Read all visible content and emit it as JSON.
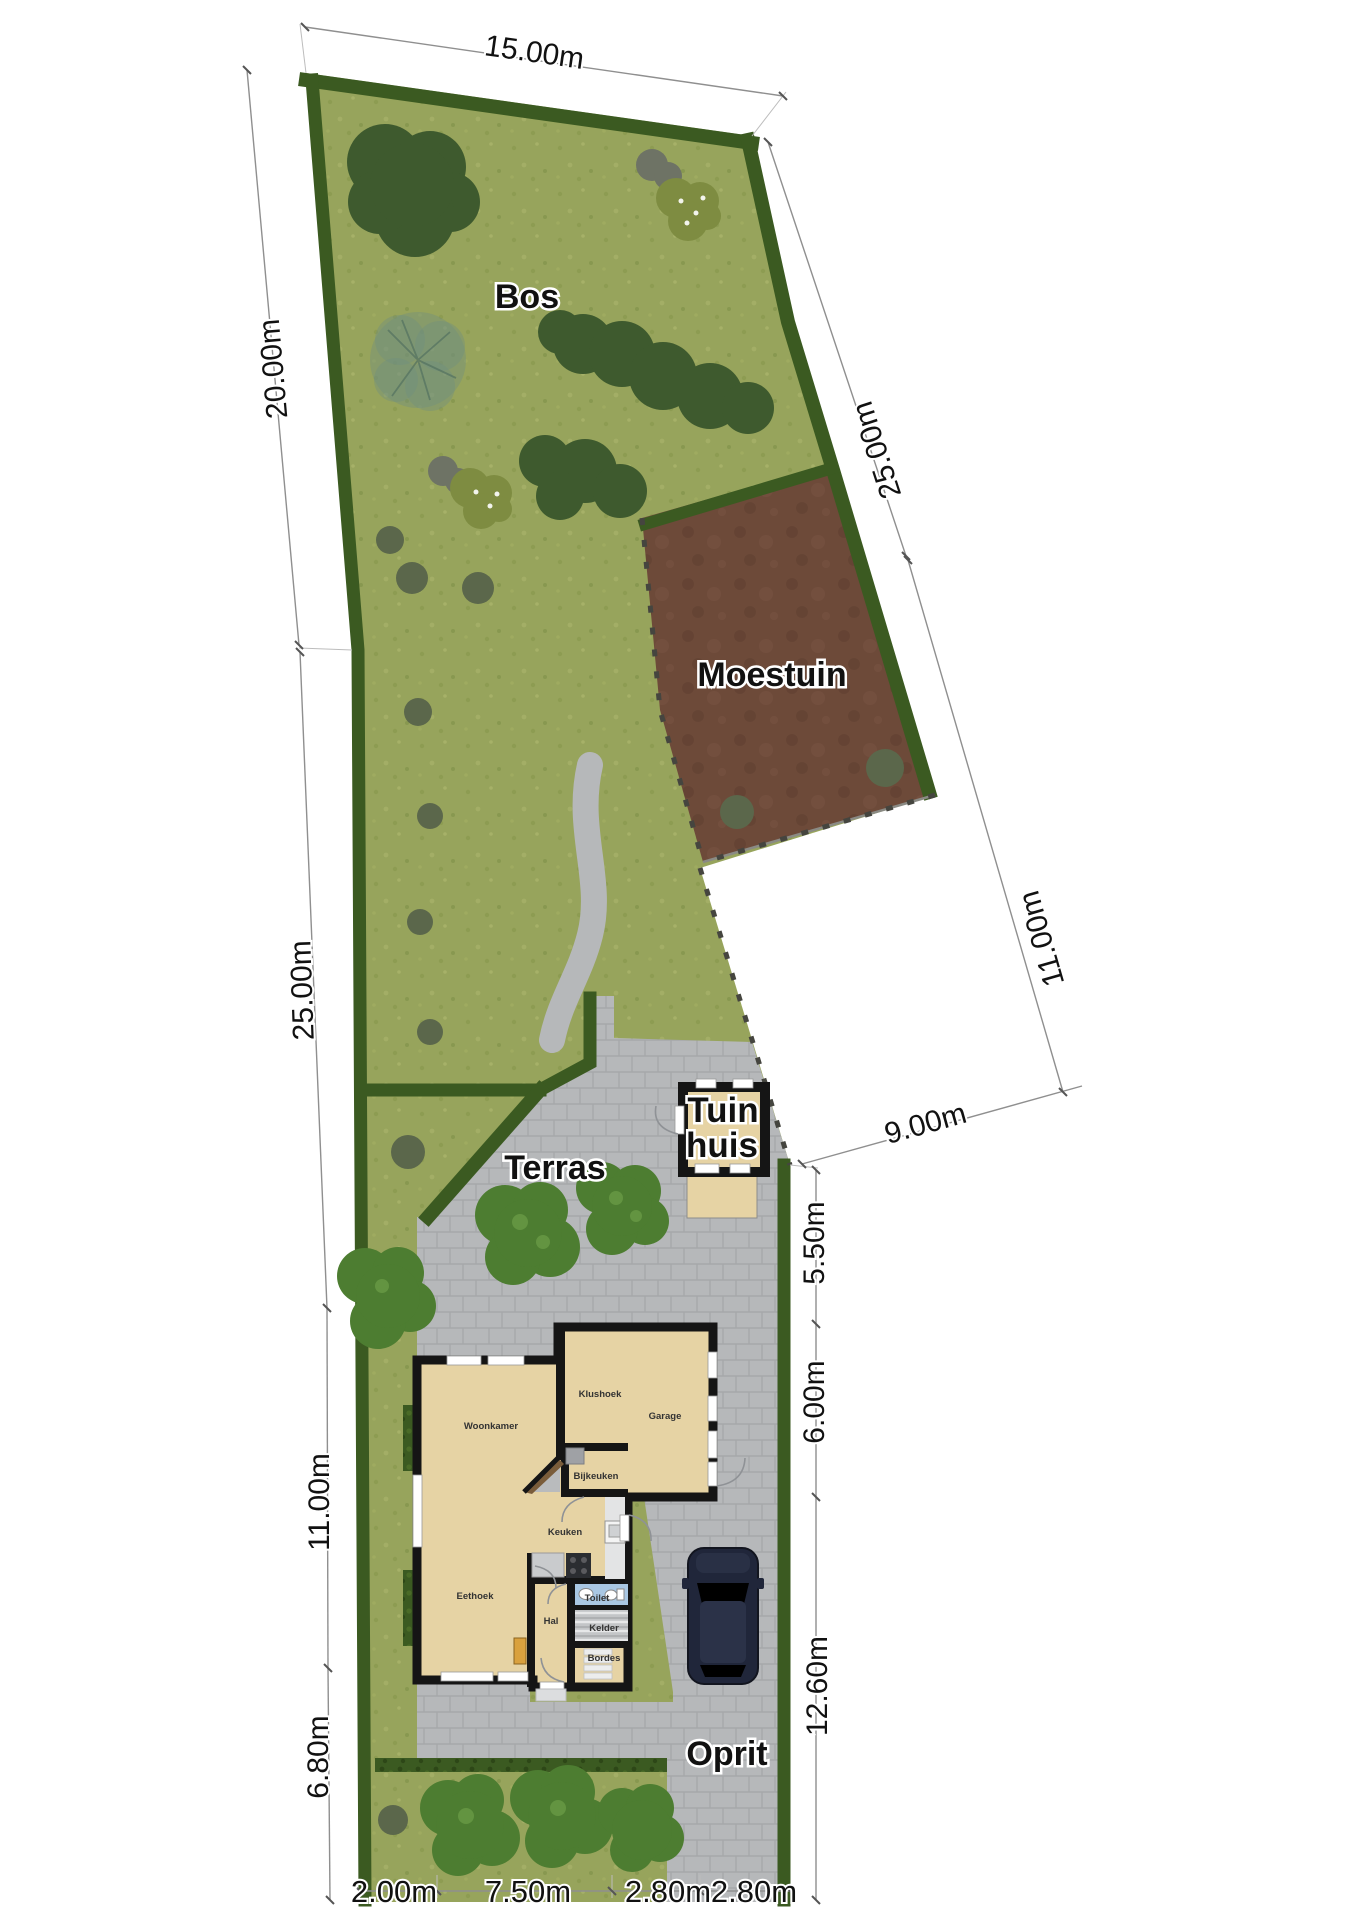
{
  "title": "Perceelplattegrond / site plan",
  "labels": {
    "areas": {
      "bos": "Bos",
      "moestuin": "Moestuin",
      "terras": "Terras",
      "tuinhuis_line1": "Tuin",
      "tuinhuis_line2": "huis",
      "oprit": "Oprit"
    },
    "rooms": {
      "woonkamer": "Woonkamer",
      "klushoek": "Klushoek",
      "garage": "Garage",
      "bijkeuken": "Bijkeuken",
      "keuken": "Keuken",
      "eethoek": "Eethoek",
      "hal": "Hal",
      "toilet": "Toilet",
      "kelder": "Kelder",
      "bordes": "Bordes"
    },
    "dims": {
      "top": "15.00m",
      "left_upper": "20.00m",
      "left_mid": "25.00m",
      "left_lower": "11.00m",
      "left_bottom": "6.80m",
      "right_upper": "25.00m",
      "right_mid": "11.00m",
      "bend": "9.00m",
      "right_550": "5.50m",
      "right_600": "6.00m",
      "right_1260": "12.60m",
      "bottom_1": "2.00m",
      "bottom_2": "7.50m",
      "bottom_3": "2.80m",
      "bottom_4": "2.80m"
    }
  },
  "colors": {
    "lawn": "#97a45c",
    "hedge": "#3b5a21",
    "soil": "#6d4a39",
    "paving": "#b6b8ba",
    "wall": "#151515",
    "floor": "#e6d3a4",
    "toilet": "#a9c7e3",
    "tree-dark": "#3e5a2e",
    "tree-bright": "#4d7d31",
    "olive": "#7e8c41",
    "gray-tree": "#6e7365",
    "shrub": "#5b674b",
    "car-body": "#20263a",
    "car-roof": "#2b3248",
    "fence": "#45453f",
    "dim-line": "#8f8f8f",
    "dim-text": "#111111",
    "label": "#111111",
    "room-text": "#333333"
  }
}
